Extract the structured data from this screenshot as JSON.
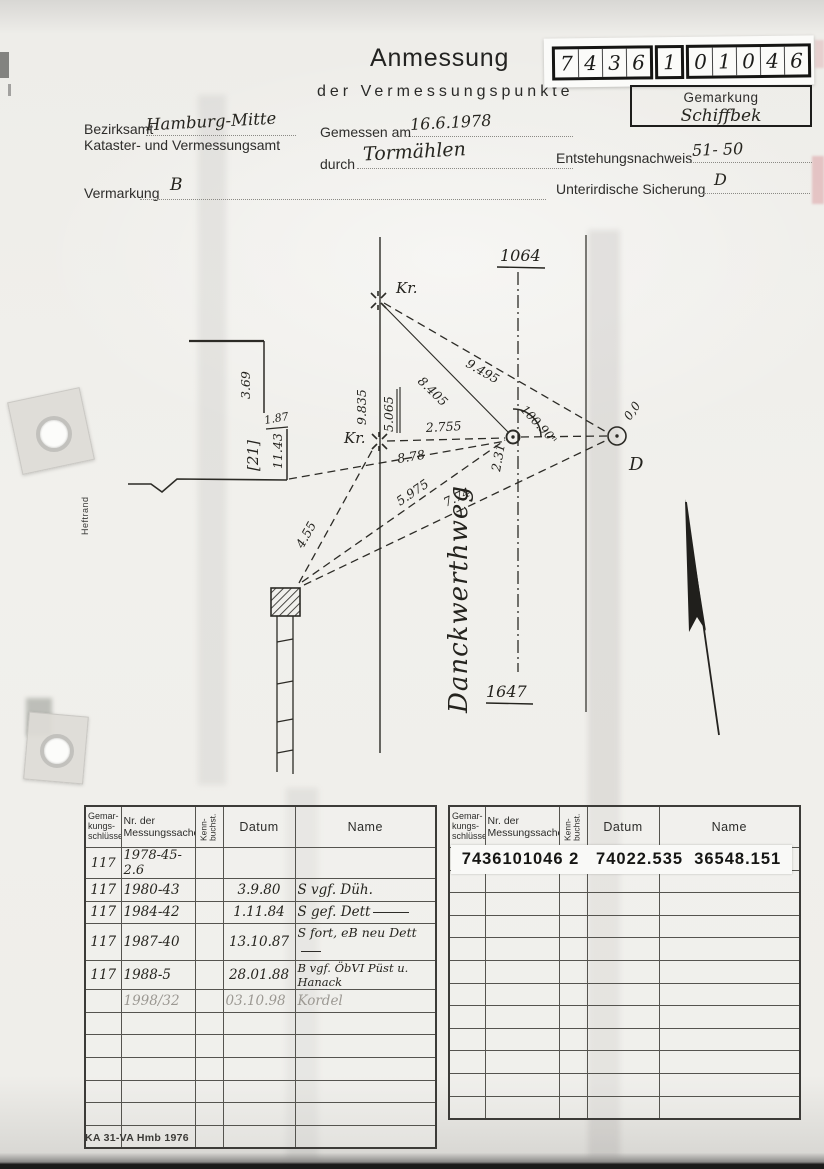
{
  "header": {
    "title": "Anmessung",
    "subtitle": "der Vermessungspunkte",
    "digits": [
      "7",
      "4",
      "3",
      "6",
      "1",
      "0",
      "1",
      "0",
      "4",
      "6"
    ],
    "gemarkung_label": "Gemarkung",
    "gemarkung_value": "Schiffbek",
    "office_line1_label": "Bezirksamt",
    "office_line1_value": "Hamburg-Mitte",
    "office_line2": "Kataster- und Vermessungsamt",
    "measured_label": "Gemessen am",
    "measured_value": "16.6.1978",
    "by_label": "durch",
    "by_value": "Tormählen",
    "evidence_label": "Entstehungsnachweis",
    "evidence_value": "51- 50",
    "marking_label": "Vermarkung",
    "marking_value": "B",
    "underground_label": "Unterirdische Sicherung",
    "underground_value": "D"
  },
  "sketch": {
    "street": "Danckwerthweg",
    "parcel_top": "1064",
    "parcel_bottom": "1647",
    "kr1": "Kr.",
    "kr2": "Kr.",
    "point_d": "D",
    "m": {
      "a369": "3.69",
      "a187": "1.87",
      "a1143": "11.43",
      "a21": "[21]",
      "a9835": "9.835",
      "a5065": "5.065",
      "a8405": "8.405",
      "a9495": "9.495",
      "a2755": "2.755",
      "a878": "8.78",
      "a455": "4.55",
      "a5975": "5.975",
      "a774": "7.74",
      "a231": "2.31",
      "a00": "0,0",
      "angle": "100.90ⁿ"
    }
  },
  "tables": {
    "headers": {
      "gem": "Gemar-\nkungs-\nschlüssel",
      "nr": "Nr. der\nMessungssache",
      "kenn": "Kenn-\nbuchst.",
      "datum": "Datum",
      "name": "Name"
    },
    "left_rows": [
      {
        "gem": "117",
        "nr": "1978-45-2.6",
        "datum": "",
        "name": ""
      },
      {
        "gem": "117",
        "nr": "1980-43",
        "datum": "3.9.80",
        "name": "S vgf. Düh."
      },
      {
        "gem": "117",
        "nr": "1984-42",
        "datum": "1.11.84",
        "name": "S gef. Dett"
      },
      {
        "gem": "117",
        "nr": "1987-40",
        "datum": "13.10.87",
        "name": "S fort, eB neu Dett"
      },
      {
        "gem": "117",
        "nr": "1988-5",
        "datum": "28.01.88",
        "name": "B vgf. ÖbVI Püst u. Hanack"
      },
      {
        "gem": "",
        "nr": "1998/32",
        "datum": "03.10.98",
        "name": "Kordel"
      }
    ],
    "right_sticker": "7436101046 2   74022.535  36548.151"
  },
  "margins": {
    "heftrand": "Heftrand",
    "footer": "KA 31-VA Hmb 1976"
  }
}
